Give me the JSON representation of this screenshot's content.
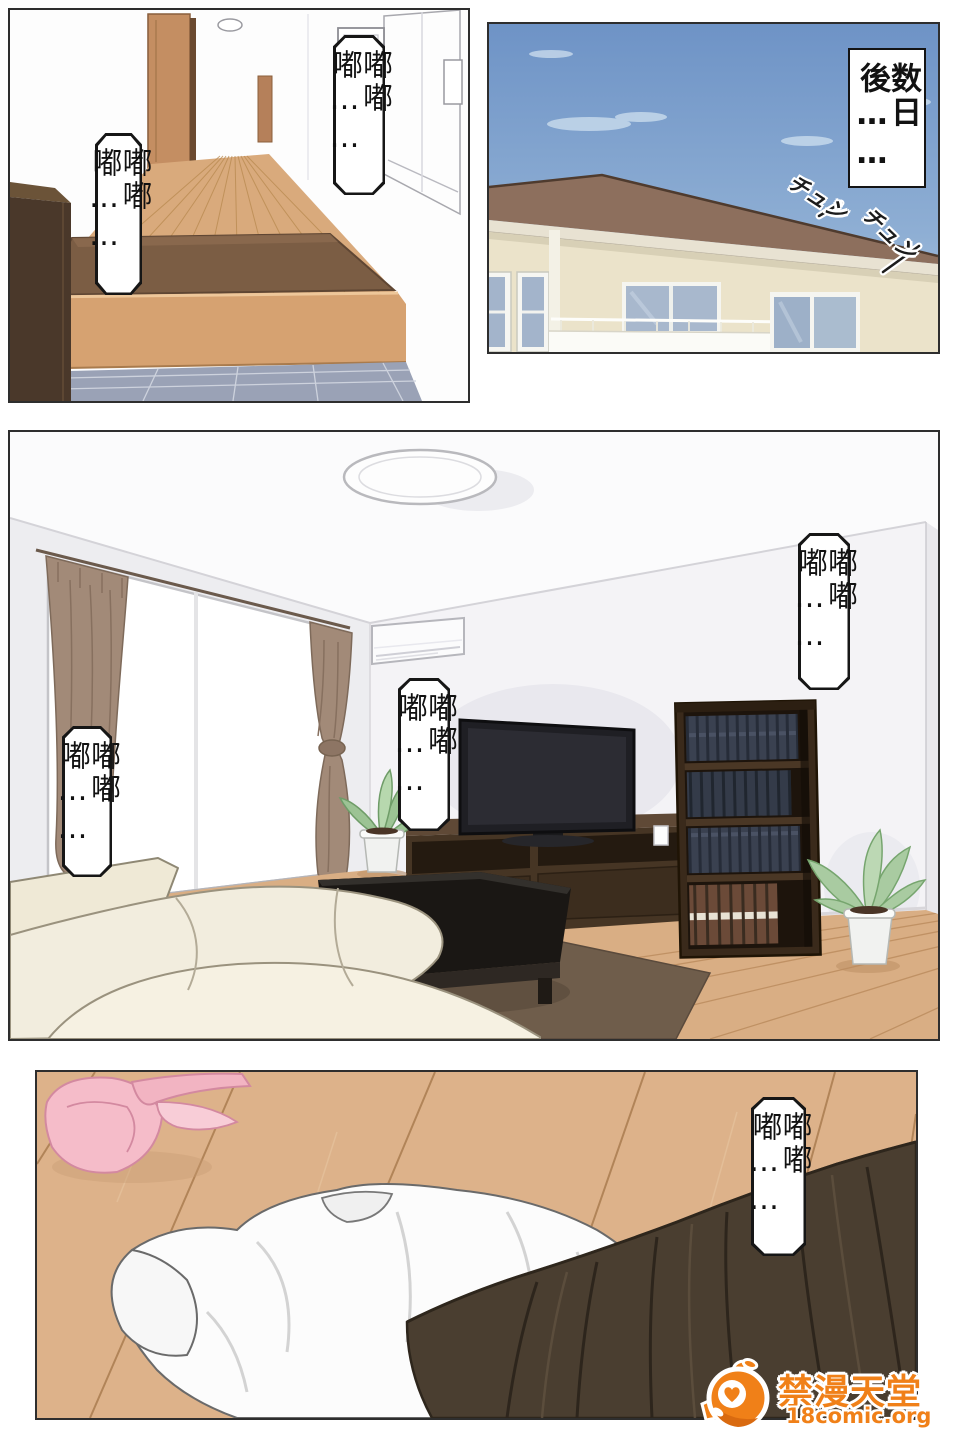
{
  "panel1": {
    "bubble_left": "嘟嘟嘟……",
    "bubble_top_right": "嘟嘟嘟……"
  },
  "panel2": {
    "caption": "数日後……",
    "sfx_left": "チュン",
    "sfx_right": "チュン"
  },
  "panel3": {
    "bubble_left": "嘟嘟嘟……",
    "bubble_center": "嘟嘟嘟……",
    "bubble_right": "嘟嘟嘟……"
  },
  "panel4": {
    "bubble": "嘟嘟嘟……"
  },
  "watermark": {
    "site_name": "禁漫天堂",
    "site_url": "18comic.org",
    "brand_color": "#f08018"
  },
  "colors": {
    "panel_border": "#2e2e2e",
    "sky_top": "#6e93c6",
    "sky_bottom": "#abc4df",
    "roof": "#8d6f5d",
    "wall_cream": "#ebe3ca",
    "wood_floor": "#d9ac80",
    "entry_mat": "#7b5d44",
    "tile": "#9aa2b6",
    "curtain": "#a28a78",
    "sofa": "#f3eedf",
    "rug": "#6f5d4b",
    "bookshelf": "#3a2a1b",
    "skirt": "#4a3e30",
    "bra_pink": "#f5bcc9"
  }
}
